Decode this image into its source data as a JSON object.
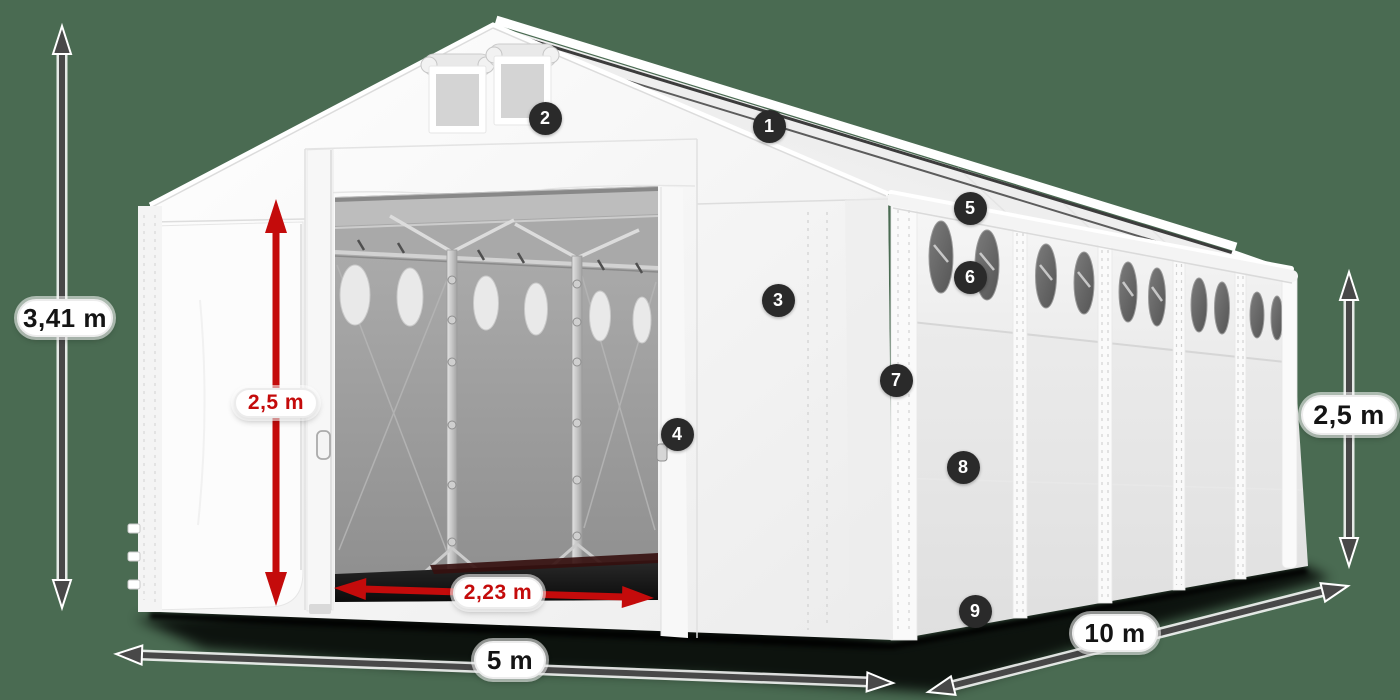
{
  "scene": {
    "background_color": "#4a6b52",
    "description": "3D product render of a white PVC storage tent (5 x 10 m) with dimension arrows and numbered feature callouts",
    "view": "front-left perspective with sliding front door open"
  },
  "palette": {
    "arrow_gray": "#484848",
    "arrow_red": "#c40b0b",
    "badge_bg": "#2a2a2a",
    "badge_text": "#ffffff",
    "label_bg": "#ffffff",
    "label_text_dark": "#141414",
    "label_text_red": "#c40b0b",
    "tent_white": "#f7f7f7",
    "interior_gray": "#9a9a9a"
  },
  "dimension_labels": {
    "total_height": "3,41 m",
    "door_height": "2,5 m",
    "door_width": "2,23 m",
    "front_width": "5 m",
    "side_length": "10 m",
    "side_wall_height": "2,5 m"
  },
  "callout_badges": [
    {
      "number": "1"
    },
    {
      "number": "2"
    },
    {
      "number": "3"
    },
    {
      "number": "4"
    },
    {
      "number": "5"
    },
    {
      "number": "6"
    },
    {
      "number": "7"
    },
    {
      "number": "8"
    },
    {
      "number": "9"
    }
  ]
}
